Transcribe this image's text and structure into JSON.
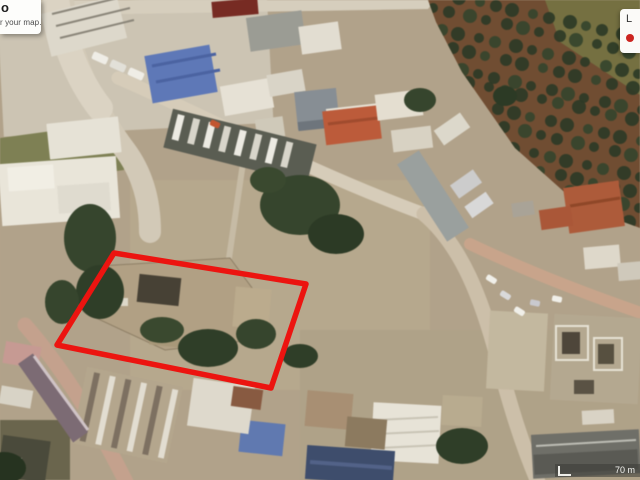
{
  "overlay": {
    "tooltip": {
      "line1": "o",
      "line2": "r your map."
    },
    "legend_panel": {
      "label": "L",
      "marker_icon": "red-dot-icon",
      "marker_color": "#cc2420"
    },
    "scale_bar": {
      "distance_label": "70 m"
    }
  },
  "map": {
    "highlight_outline_color": "#ec1410"
  }
}
